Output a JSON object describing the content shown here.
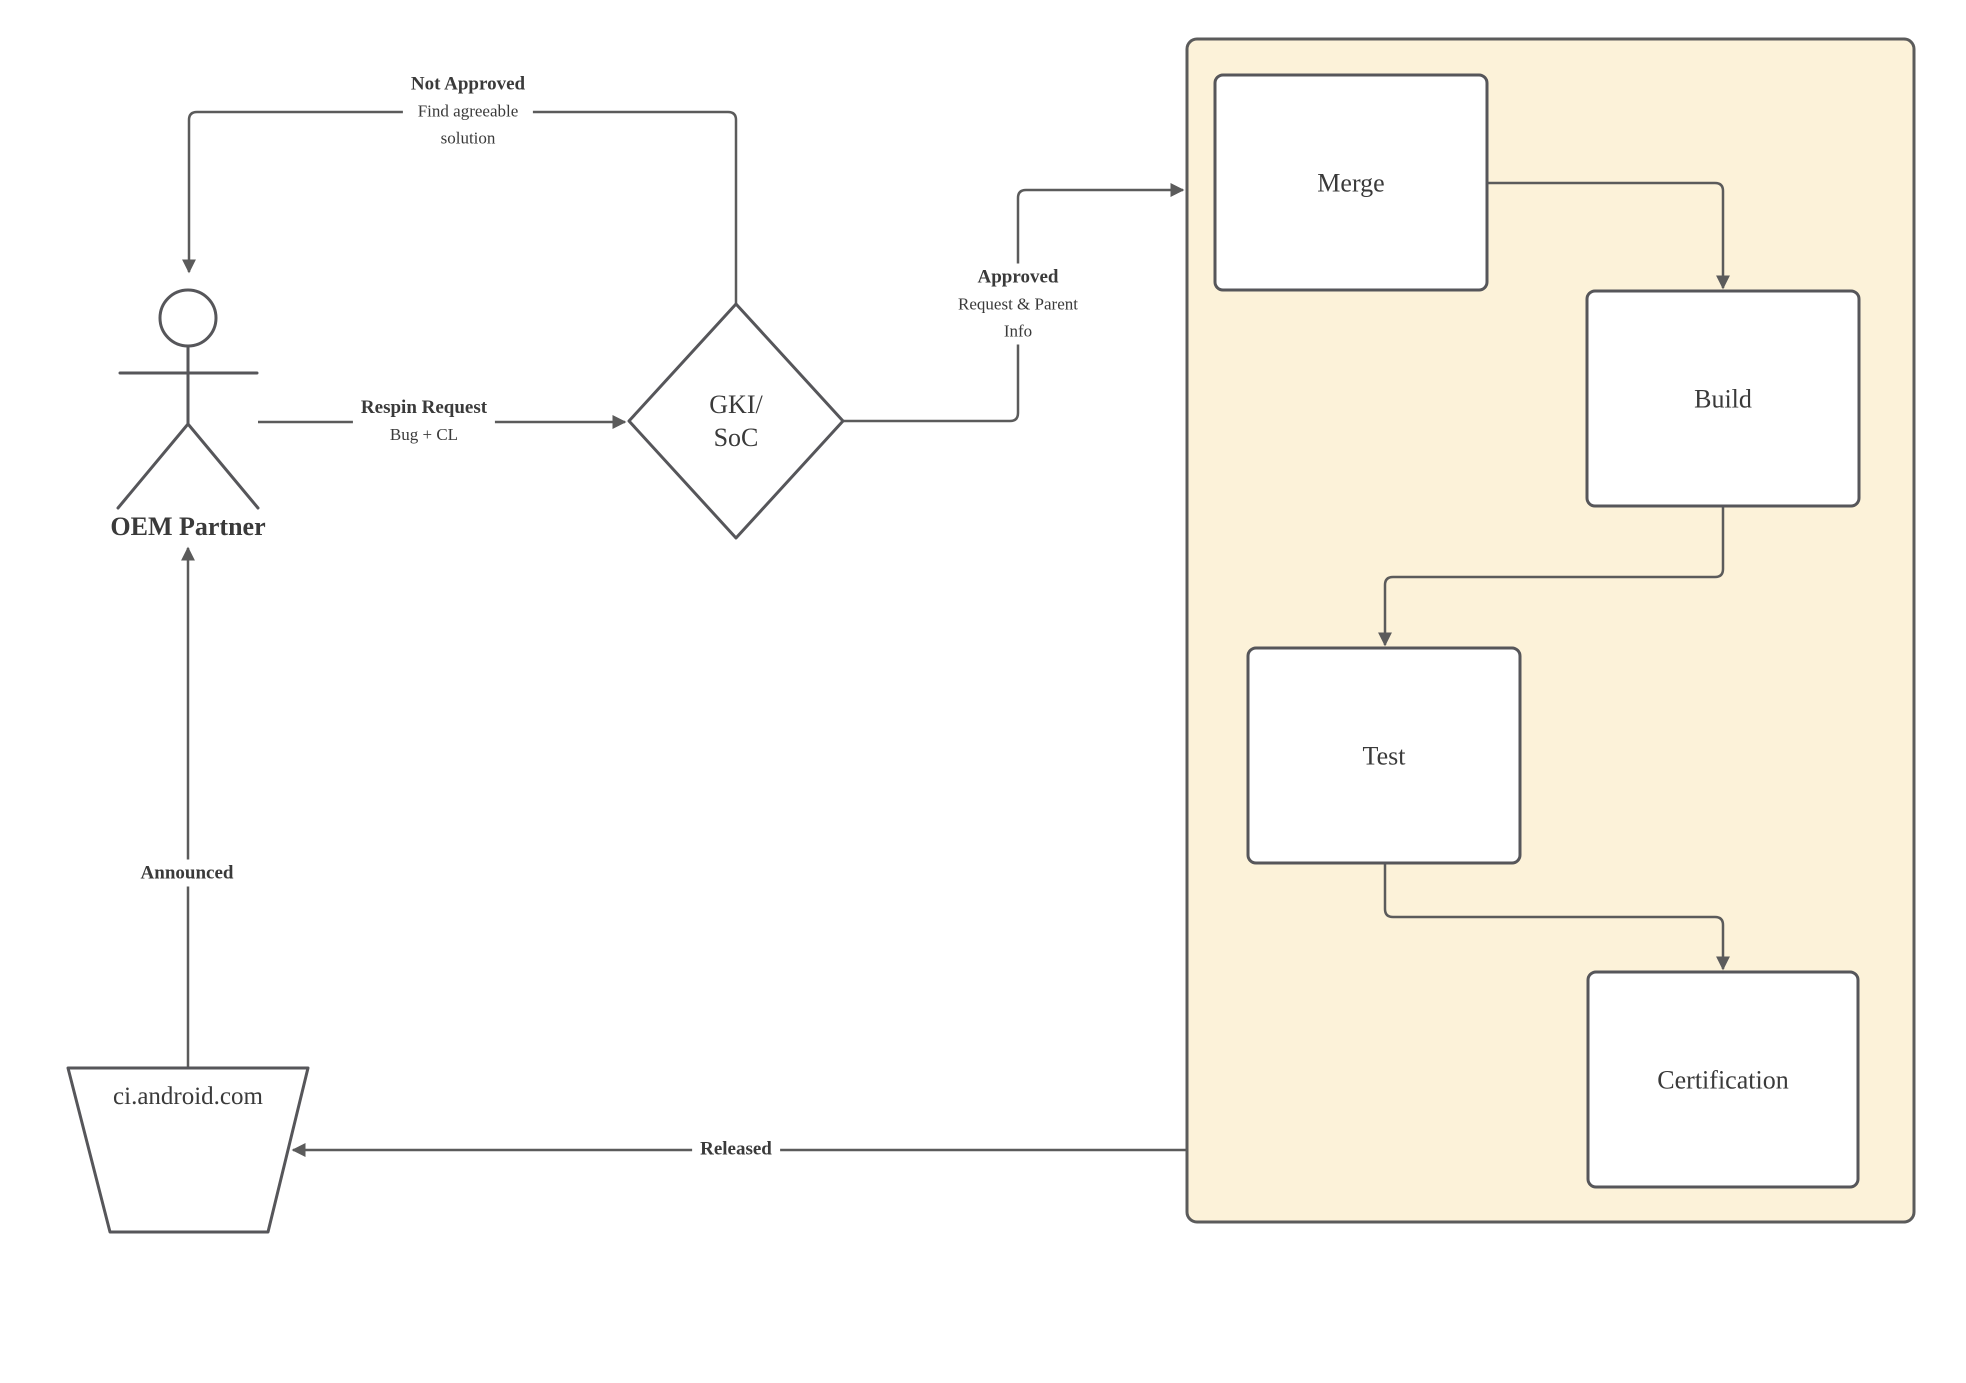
{
  "colors": {
    "line": "#5b5b5b",
    "text": "#3a3a3a",
    "node_fill": "#ffffff",
    "node_stroke": "#56565a",
    "container_fill": "#fcf2d9",
    "container_stroke": "#5b5b5b",
    "label_bg": "#ffffff",
    "page_bg": "#ffffff"
  },
  "actor": {
    "label": "OEM Partner"
  },
  "decision": {
    "line1": "GKI/",
    "line2": "SoC"
  },
  "datastore": {
    "label": "ci.android.com"
  },
  "pipeline": {
    "merge": "Merge",
    "build": "Build",
    "test": "Test",
    "certification": "Certification"
  },
  "edges": {
    "not_approved": {
      "title": "Not Approved",
      "sub1": "Find agreeable",
      "sub2": "solution"
    },
    "respin": {
      "title": "Respin Request",
      "sub": "Bug + CL"
    },
    "approved": {
      "title": "Approved",
      "sub1": "Request & Parent",
      "sub2": "Info"
    },
    "announced": {
      "title": "Announced"
    },
    "released": {
      "title": "Released"
    }
  }
}
